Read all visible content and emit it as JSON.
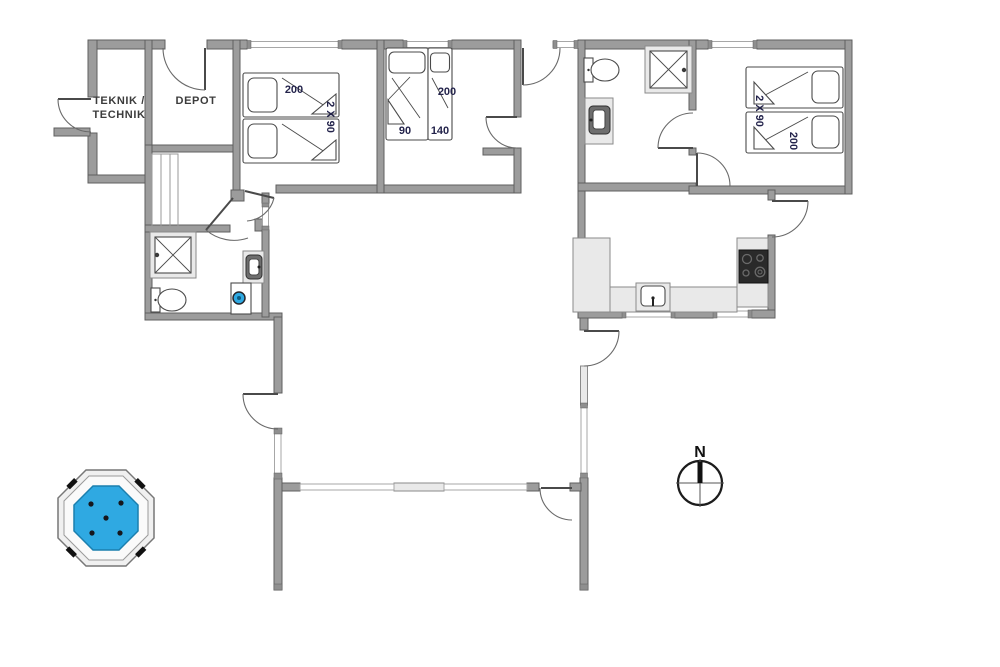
{
  "rooms": {
    "teknik": {
      "line1": "TEKNIK /",
      "line2": "TECHNIK"
    },
    "depot": {
      "label": "DEPOT"
    },
    "bedroom_left": {
      "bed_length": "200",
      "bed_widths": "2 X 90"
    },
    "bedroom_middle": {
      "bed_length": "200",
      "bed1_width": "90",
      "bed2_width": "140"
    },
    "bedroom_right": {
      "bed_widths": "2 X 90",
      "bed_length": "200"
    }
  },
  "compass": {
    "north": "N"
  },
  "colors": {
    "wall": "#9c9c9c",
    "wall-dark": "#5f5f5f",
    "fixture": "#e9e9e9",
    "fixture-dark": "#6e6e6e",
    "water": "#2fa9e2",
    "water-dark": "#1b7fae",
    "label": "#23234b",
    "cooktop": "#2a2a2a"
  }
}
